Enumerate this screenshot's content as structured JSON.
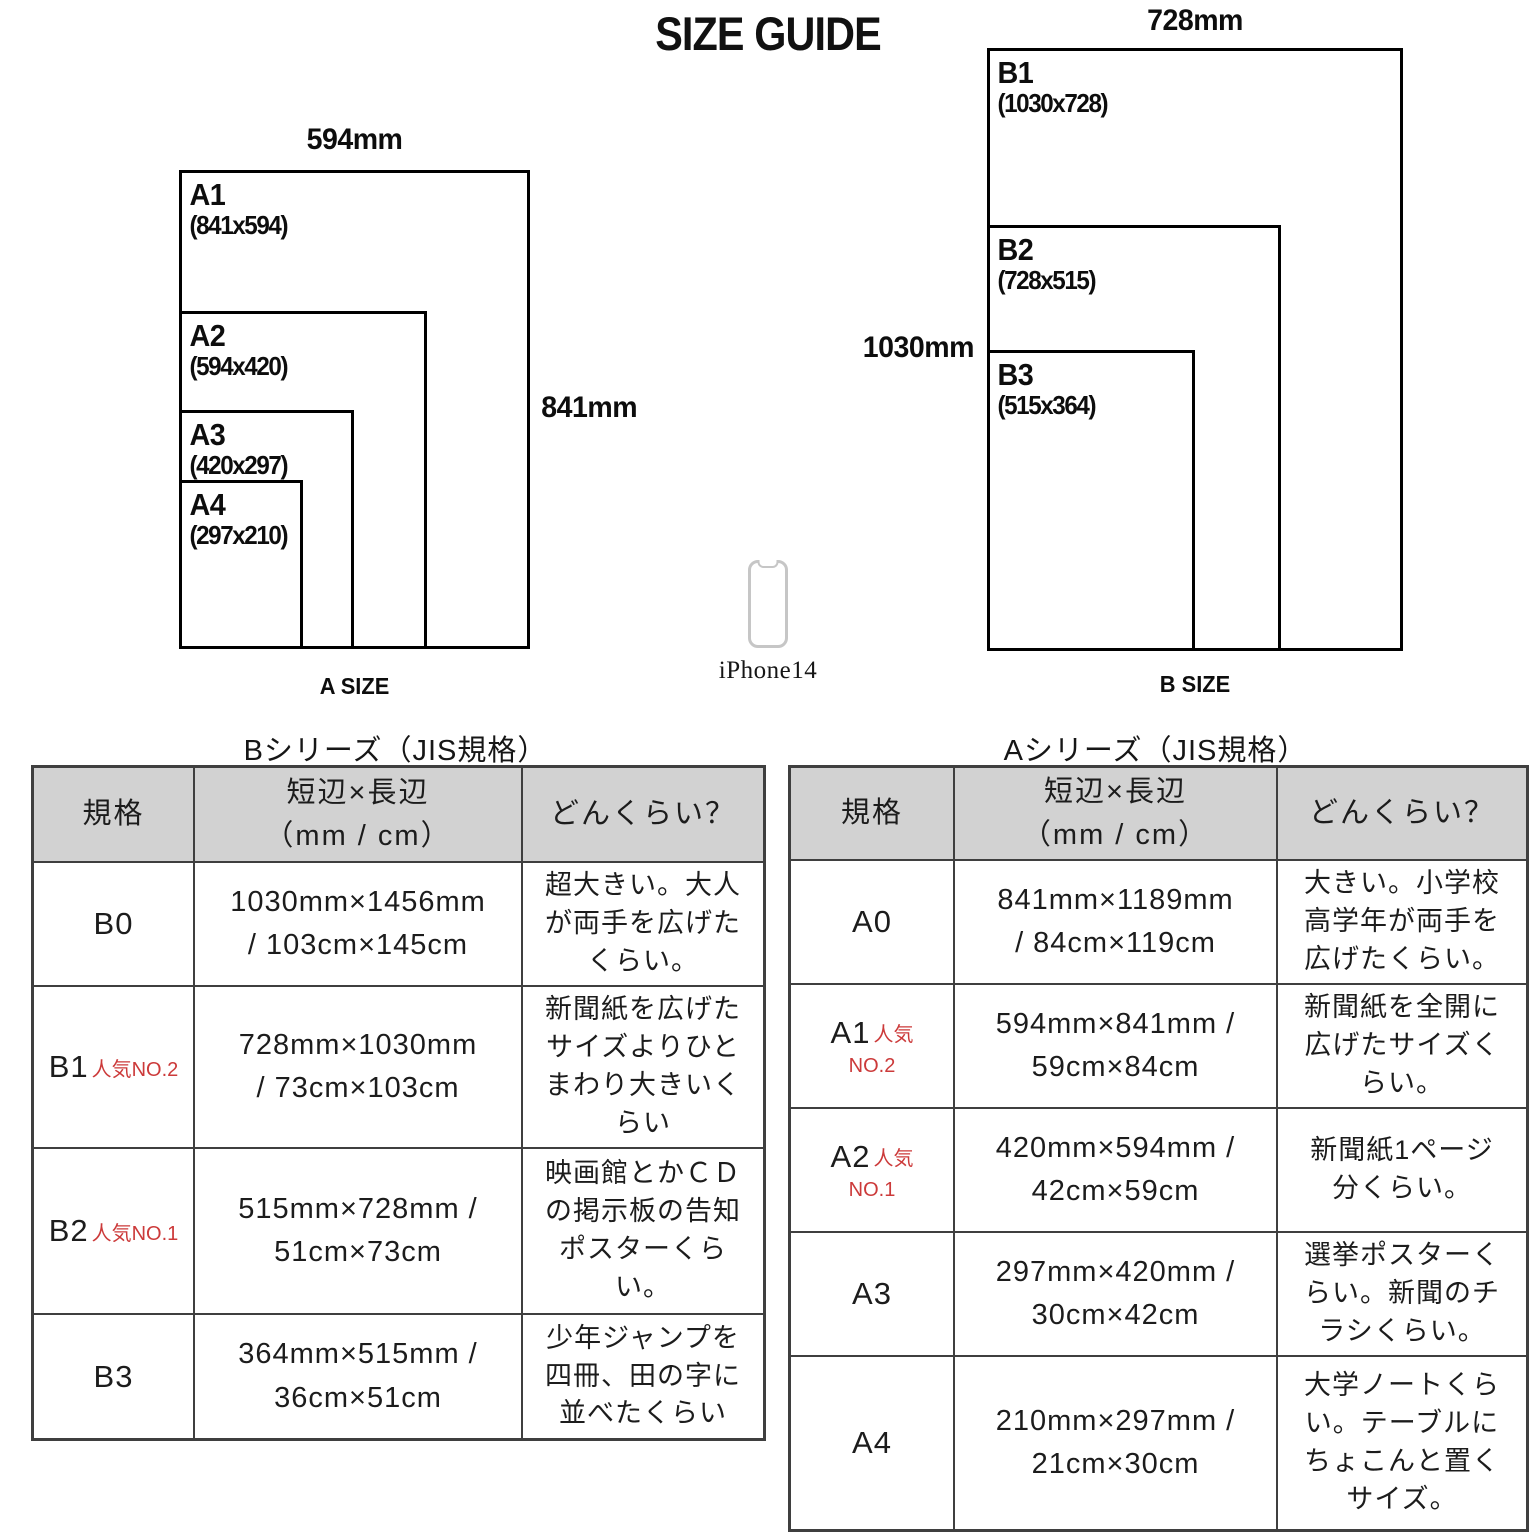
{
  "page": {
    "title": "SIZE GUIDE"
  },
  "colors": {
    "badge_red": "#cc3a3a",
    "header_bg": "#d2d2d2",
    "table_border": "#3f3f3f",
    "phone_gray": "#c6c6c6"
  },
  "diagram_a": {
    "top_dim": "594mm",
    "side_dim": "841mm",
    "caption": "A SIZE",
    "sheets": [
      {
        "name": "A1",
        "dims": "(841x594)"
      },
      {
        "name": "A2",
        "dims": "(594x420)"
      },
      {
        "name": "A3",
        "dims": "(420x297)"
      },
      {
        "name": "A4",
        "dims": "(297x210)"
      }
    ]
  },
  "diagram_b": {
    "top_dim": "728mm",
    "side_dim": "1030mm",
    "caption": "B SIZE",
    "sheets": [
      {
        "name": "B1",
        "dims": "(1030x728)"
      },
      {
        "name": "B2",
        "dims": "(728x515)"
      },
      {
        "name": "B3",
        "dims": "(515x364)"
      }
    ]
  },
  "phone": {
    "label": "iPhone14"
  },
  "table_b": {
    "title": "Bシリーズ（JIS規格）",
    "headers": {
      "spec": "規格",
      "size": "短辺×長辺\n（mm / cm）",
      "desc": "どんくらい？"
    },
    "rows": [
      {
        "code": "B0",
        "badge": "",
        "size": "1030mm×1456mm\n/ 103cm×145cm",
        "desc": "超大きい。大人\nが両手を広げた\nくらい。"
      },
      {
        "code": "B1",
        "badge": "人気NO.2",
        "size": "728mm×1030mm\n/ 73cm×103cm",
        "desc": "新聞紙を広げた\nサイズよりひと\nまわり大きいく\nらい"
      },
      {
        "code": "B2",
        "badge": "人気NO.1",
        "size": "515mm×728mm /\n51cm×73cm",
        "desc": "映画館とかＣＤ\nの掲示板の告知\nポスターくら\nい。"
      },
      {
        "code": "B3",
        "badge": "",
        "size": "364mm×515mm /\n36cm×51cm",
        "desc": "少年ジャンプを\n四冊、田の字に\n並べたくらい"
      }
    ]
  },
  "table_a": {
    "title": "Aシリーズ（JIS規格）",
    "headers": {
      "spec": "規格",
      "size": "短辺×長辺\n（mm / cm）",
      "desc": "どんくらい？"
    },
    "rows": [
      {
        "code": "A0",
        "badge": "",
        "badge2": "",
        "size": "841mm×1189mm\n/ 84cm×119cm",
        "desc": "大きい。小学校\n高学年が両手を\n広げたくらい。"
      },
      {
        "code": "A1",
        "badge": "人気",
        "badge2": "NO.2",
        "size": "594mm×841mm /\n59cm×84cm",
        "desc": "新聞紙を全開に\n広げたサイズく\nらい。"
      },
      {
        "code": "A2",
        "badge": "人気",
        "badge2": "NO.1",
        "size": "420mm×594mm /\n42cm×59cm",
        "desc": "新聞紙1ページ\n分くらい。"
      },
      {
        "code": "A3",
        "badge": "",
        "badge2": "",
        "size": "297mm×420mm /\n30cm×42cm",
        "desc": "選挙ポスターく\nらい。新聞のチ\nラシくらい。"
      },
      {
        "code": "A4",
        "badge": "",
        "badge2": "",
        "size": "210mm×297mm /\n21cm×30cm",
        "desc": "大学ノートくら\nい。テーブルに\nちょこんと置く\nサイズ。"
      }
    ]
  }
}
